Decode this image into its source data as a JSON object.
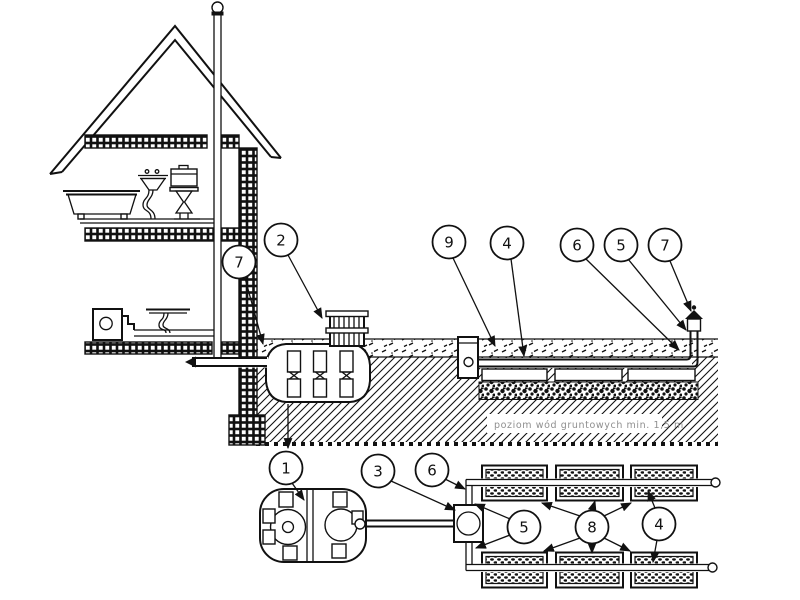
{
  "figure": {
    "background_color": "#ffffff",
    "ink_color": "#111111",
    "groundwater_label": {
      "text": "poziom wód gruntowych min. 1,5 m",
      "color": "#8f8f8f"
    },
    "callouts": [
      {
        "id": "vent-stack-house",
        "label": "7"
      },
      {
        "id": "tank-riser",
        "label": "2"
      },
      {
        "id": "distribution-well",
        "label": "9"
      },
      {
        "id": "drain-pipe-section",
        "label": "4"
      },
      {
        "id": "pipe-elbow-section",
        "label": "6"
      },
      {
        "id": "vent-riser-section",
        "label": "5"
      },
      {
        "id": "vent-cap-section",
        "label": "7"
      },
      {
        "id": "septic-tank",
        "label": "1"
      },
      {
        "id": "distribution-box-plan",
        "label": "3"
      },
      {
        "id": "manifold-pipe-plan",
        "label": "6"
      },
      {
        "id": "lateral-pipes-plan",
        "label": "5"
      },
      {
        "id": "drain-trenches-plan",
        "label": "8"
      },
      {
        "id": "trench-right-plan",
        "label": "4"
      }
    ]
  }
}
